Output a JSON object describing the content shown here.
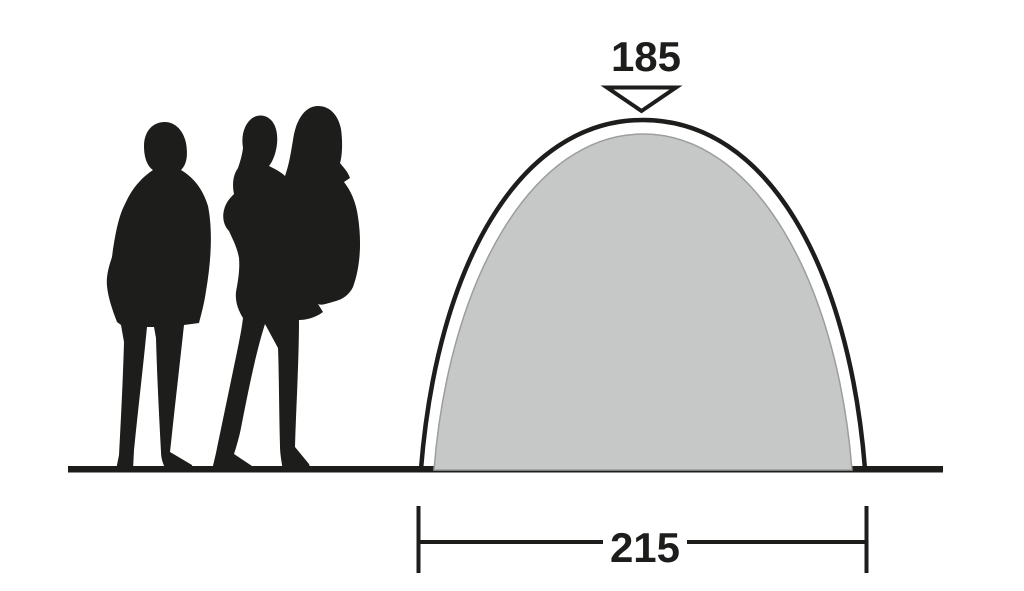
{
  "figure": {
    "labels": {
      "peak_height": "185",
      "base_width": "215"
    },
    "colors": {
      "ink": "#1d1d1b",
      "tent_fill": "#c6c8c7",
      "background": "#ffffff"
    },
    "icons": {
      "height_marker": "triangle-down-icon"
    }
  }
}
